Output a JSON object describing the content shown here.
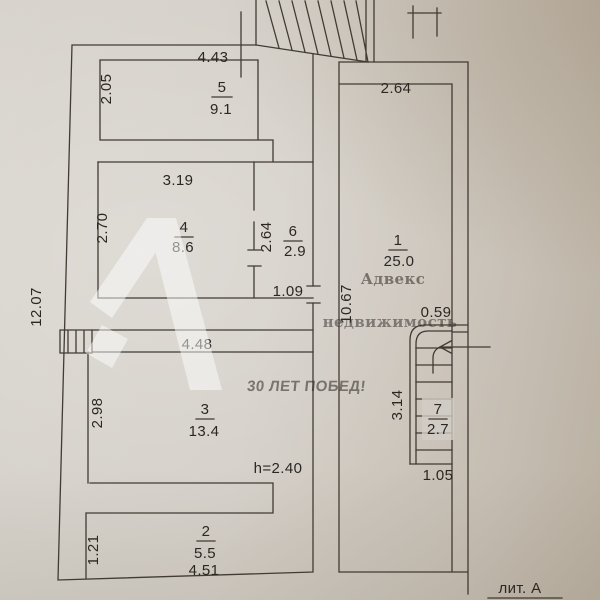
{
  "watermark": {
    "logo_name": "advecs-logo",
    "brand": "Адвекс",
    "brand_sub": "недвижимость",
    "slogan": "30 ЛЕТ ПОБЕД!"
  },
  "plan": {
    "litera": "лит. А",
    "height_note": "h=2.40",
    "total_height_dim": "12.07",
    "rooms": {
      "r1": {
        "num": "1",
        "area": "25.0",
        "width": "2.64",
        "height": "10.67"
      },
      "r2": {
        "num": "2",
        "area": "5.5",
        "width": "4.51",
        "height": "1.21"
      },
      "r3": {
        "num": "3",
        "area": "13.4",
        "width": "4.48",
        "height": "2.98"
      },
      "r4": {
        "num": "4",
        "area": "8.6",
        "width": "3.19",
        "height": "2.70"
      },
      "r5": {
        "num": "5",
        "area": "9.1",
        "width": "4.43",
        "height": "2.05"
      },
      "r6": {
        "num": "6",
        "area": "2.9",
        "width": "1.09",
        "height": "2.64"
      },
      "r7": {
        "num": "7",
        "area": "2.7",
        "width": "1.05",
        "height": "3.14",
        "landing": "0.59"
      }
    }
  }
}
